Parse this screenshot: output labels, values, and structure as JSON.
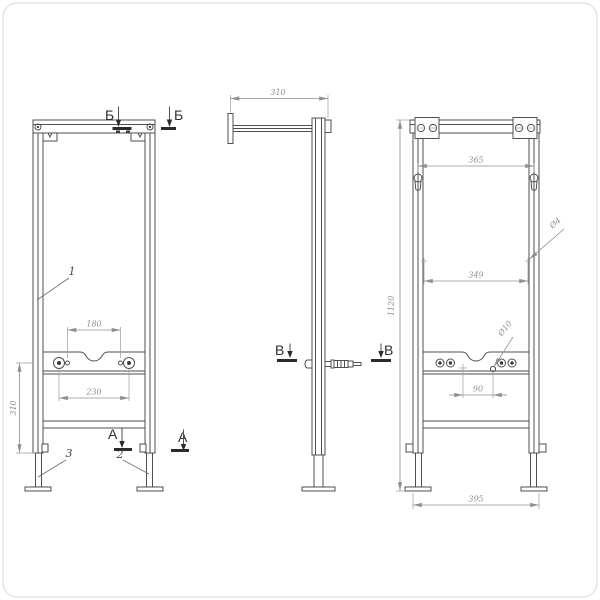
{
  "palette": {
    "background": "#ffffff",
    "line": "#4f4f4f",
    "dimension": "#8f8f8f",
    "section_mark": "#2b2b2b",
    "card_border": "#e3e3e3"
  },
  "views": {
    "front": {
      "section_top_label": "Б",
      "section_bottom_label": "А",
      "dim_pin_spacing": "180",
      "dim_stud_spacing": "230",
      "dim_lower_height": "310",
      "callout_frame": "1",
      "callout_leg_right": "2",
      "callout_leg_left": "3"
    },
    "side": {
      "dim_depth": "310",
      "section_mid_label": "В"
    },
    "rear": {
      "dim_slot_spacing": "365",
      "dim_hole_spacing": "349",
      "dim_hole_offset": "90",
      "dim_width": "395",
      "dim_height": "1120",
      "hole_small_label": "Ø4",
      "hole_large_label": "Ø10"
    }
  }
}
